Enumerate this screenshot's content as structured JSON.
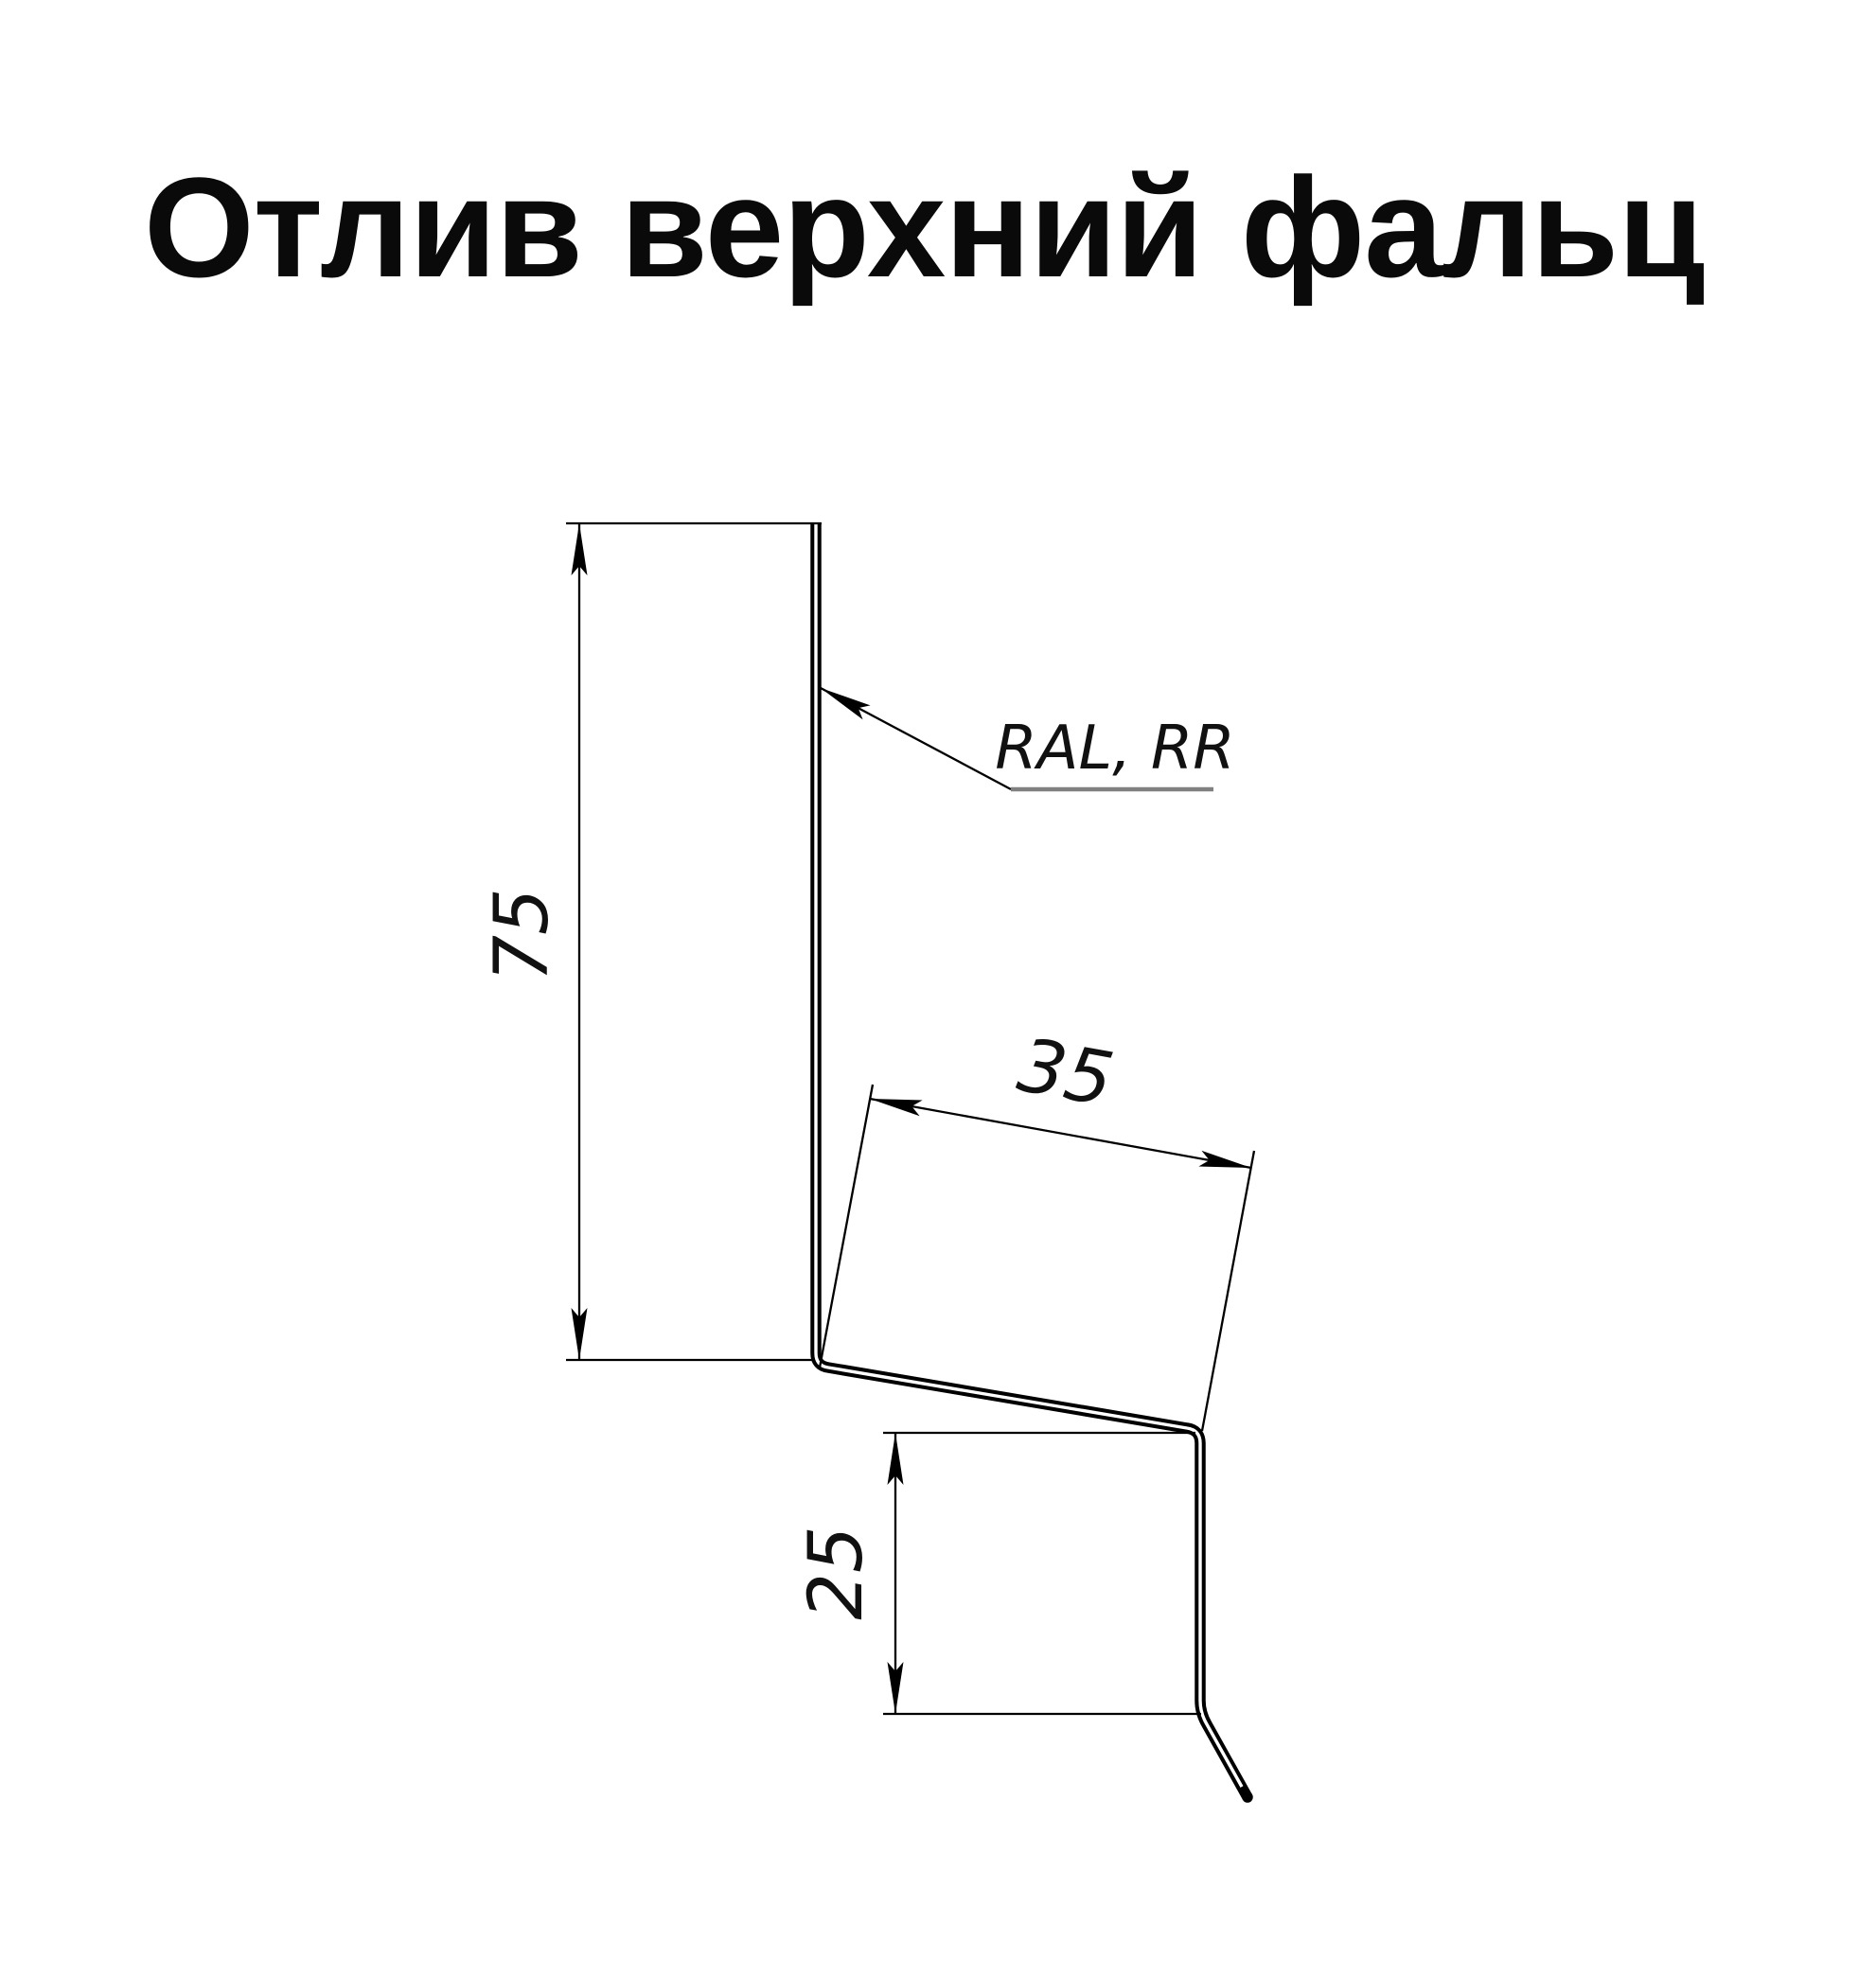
{
  "title": "Отлив верхний фальц",
  "drawing": {
    "material_label": "RAL, RR",
    "dim_height": "75",
    "dim_flange": "35",
    "dim_drop": "25",
    "colors": {
      "profile_line": "#000000",
      "dimension_line": "#000000",
      "leader_underline": "#808080",
      "background": "#ffffff"
    }
  }
}
